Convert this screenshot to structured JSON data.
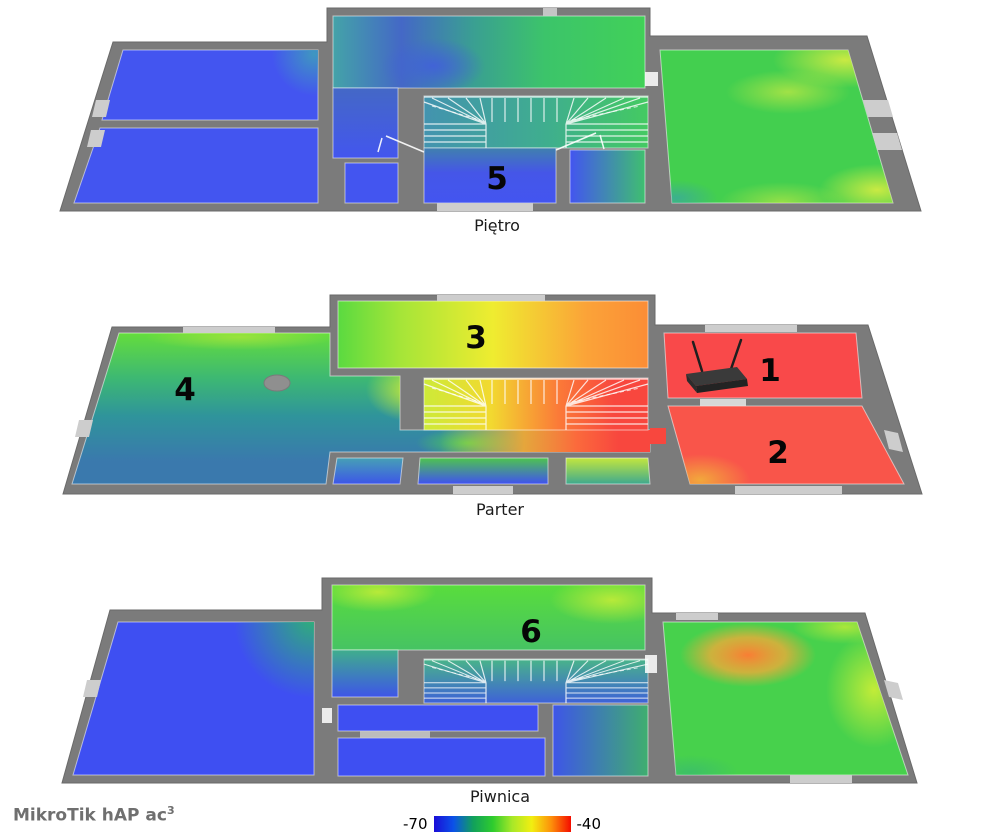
{
  "report": {
    "device_label": "MikroTik hAP ac",
    "device_label_sup": "3"
  },
  "floors": {
    "pietro": {
      "label": "Piętro",
      "marker": "5"
    },
    "parter": {
      "label": "Parter",
      "marker_room1": "1",
      "marker_room2": "2",
      "marker_room3": "3",
      "marker_room4": "4"
    },
    "piwnica": {
      "label": "Piwnica",
      "marker": "6"
    }
  },
  "legend": {
    "min_label": "-70",
    "max_label": "-40",
    "gradient_colors": [
      "#1a0dd8",
      "#0b52e8",
      "#11a05c",
      "#2ecc2e",
      "#a8e828",
      "#f2ee11",
      "#fd8f0a",
      "#f40c00"
    ]
  },
  "palette": {
    "wall": "#7b7b7b",
    "window": "#cdcdcd",
    "strong_signal": "#f8473e",
    "medium_signal": "#43cf4f",
    "weak_signal": "#4355f0"
  }
}
